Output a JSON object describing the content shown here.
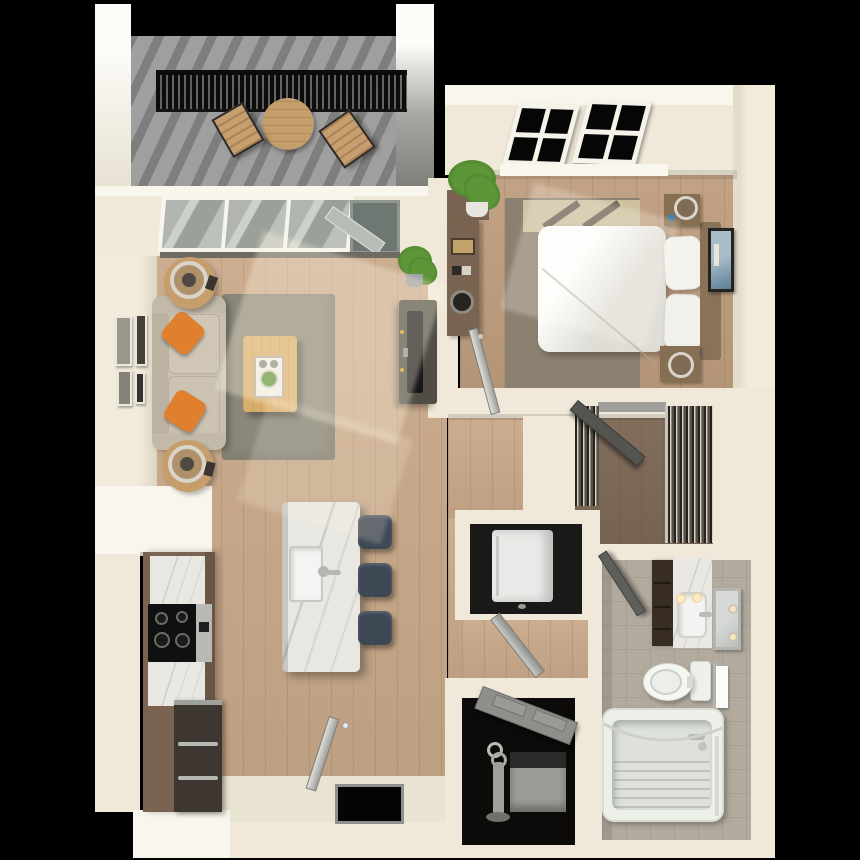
{
  "meta": {
    "scene_type": "3d-floor-plan-render",
    "view": "top-down dollhouse",
    "unit": "1 bedroom / 1 bathroom apartment",
    "canvas": {
      "width": 860,
      "height": 860
    }
  },
  "palette": {
    "background": "#000000",
    "wall": "#f0e9d9",
    "wall_bright": "#f9f6ee",
    "wood_living": "#c9a98a",
    "wood_bedroom": "#bf9e7f",
    "wood_closet": "#7d6855",
    "balcony_floor": "#9c9c9c",
    "tile": "#b2aa9d",
    "entry_tile": "#e9e3d1",
    "rug_living": "#8b8879",
    "rug_bedroom": "#8c8070",
    "sofa": "#c9c0af",
    "pillow_orange": "#e07f2e",
    "bedding": "#f7f6f1",
    "wood_furniture": "#866e52",
    "headboard": "#8a7258",
    "coffee_table": "#d9ae6a",
    "side_table": "#c59e6b",
    "marble": "#e9e7e2",
    "stool": "#3e4754",
    "cabinet": "#7a6350",
    "stove": "#101010",
    "fridge": "#3e3731",
    "tv_console": "#514d45",
    "door_gray": "#9e9e9a",
    "mat": "#050505",
    "railing": "#0c0c0c",
    "plant": "#5c9638",
    "art_blue": "#7d9cb4",
    "washer_white": "#e9eae7",
    "heater_gray": "#9b9b97"
  },
  "rooms": {
    "balcony": {
      "label": "Balcony",
      "furniture": [
        "metal-railing",
        "round-bistro-table",
        "wood-chair",
        "wood-chair"
      ]
    },
    "living": {
      "label": "Living Room",
      "furniture": [
        "sliding-glass-door",
        "sofa",
        "orange-accent-pillow",
        "orange-accent-pillow",
        "round-side-table-with-lamp",
        "round-side-table-with-lamp",
        "gallery-wall-frames",
        "area-rug",
        "coffee-table-with-tray",
        "tv-console",
        "flat-tv",
        "potted-plant"
      ]
    },
    "bedroom": {
      "label": "Bedroom",
      "furniture": [
        "four-pane-window",
        "four-pane-window",
        "queen-bed",
        "pillow",
        "pillow",
        "headboard",
        "nightstand-with-lamp",
        "nightstand-with-lamp",
        "area-rug",
        "dresser-with-decor",
        "wall-art",
        "potted-plant",
        "hinged-door"
      ]
    },
    "closet": {
      "label": "Walk-in Closet",
      "furniture": [
        "hanging-clothes-rod",
        "hanging-clothes-rod",
        "shelf",
        "hinged-door"
      ]
    },
    "bathroom": {
      "label": "Bathroom",
      "furniture": [
        "vanity-cabinet",
        "marble-counter-sink",
        "mirror-with-sconces",
        "toilet",
        "towel-bar",
        "bathtub",
        "curved-shower-rod",
        "hinged-door"
      ]
    },
    "kitchen": {
      "label": "Kitchen",
      "furniture": [
        "marble-counter",
        "cooktop-oven",
        "refrigerator",
        "island-with-sink",
        "bar-stool",
        "bar-stool",
        "bar-stool"
      ]
    },
    "laundry": {
      "label": "Laundry Closet",
      "furniture": [
        "stacked-washer-dryer",
        "hinged-door"
      ]
    },
    "utility": {
      "label": "Utility Closet",
      "furniture": [
        "water-heater",
        "vent-pipe",
        "hinged-door"
      ]
    },
    "entry": {
      "label": "Entry",
      "furniture": [
        "entry-door",
        "black-doormat"
      ]
    }
  }
}
